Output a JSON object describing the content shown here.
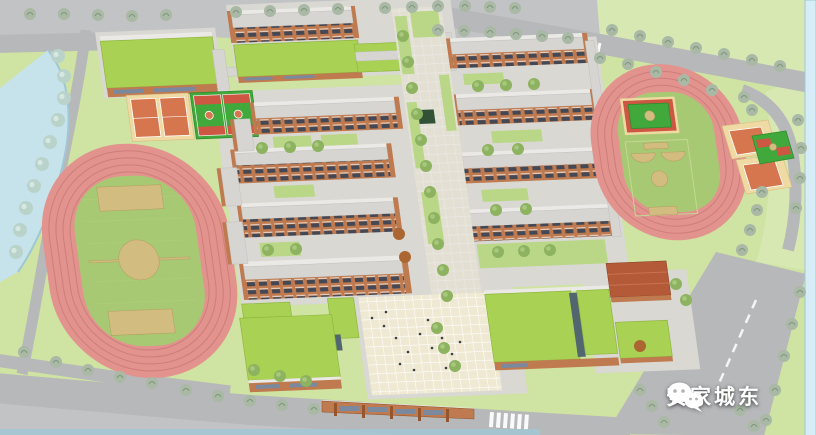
{
  "watermark": {
    "icon": "wechat-icon",
    "text": "安家城东"
  },
  "scene": {
    "type": "aerial-architectural-rendering",
    "features": [
      "running-track-west",
      "soccer-field",
      "tennis-courts-north",
      "basketball-courts-north",
      "gymnasium-green-roof",
      "dormitory-building-north",
      "classroom-buildings",
      "central-walkway",
      "entry-plaza",
      "entrance-gate",
      "canteen-green-roof",
      "running-track-east",
      "basketball-courts-east",
      "perimeter-roads",
      "street-trees",
      "waterway-west",
      "waterway-east",
      "lawn-northeast"
    ]
  },
  "colors": {
    "grass": "#cfe3a2",
    "grass-light": "#d8e8b2",
    "gray-lot": "#c2c3c5",
    "water": "#c6e3eb",
    "water-edge": "#9fc7d4",
    "water-right": "#d6edf7",
    "road": "#b7b8ba",
    "track": "#e2938e",
    "track-line": "#c2706c",
    "infield": "#a7c973",
    "marking-tan": "#d2bc80",
    "lawn": "#b9d787",
    "green-roof": "#a9d254",
    "green-roof-line": "#8fb640",
    "roof": "#d6d5d1",
    "roof-ridge": "#ebe9e5",
    "paving": "#d9d8d3",
    "plaza": "#efe9d3",
    "plaza-line": "#ffffff",
    "brick": "#bf7a4f",
    "brick-dark": "#94562f",
    "window": "#434854",
    "window-blue": "#6f8cac",
    "court-cream": "#eedaa2",
    "court-orange": "#d5764e",
    "court-green": "#41a83c",
    "court-red": "#cd5742",
    "terracotta": "#b45a39",
    "skylight": "#51666f",
    "pond": "#315237",
    "tree-street": "#a9b9a5",
    "tree-street-line": "#7f977b",
    "tree-bank": "#b9d3cb",
    "tree-bank-hi": "#d6e8e1",
    "tree-campus": "#8db361",
    "tree-campus-hi": "#a9c87e",
    "tree-autumn": "#ac6631",
    "people": "#3c4043",
    "watermark-text": "#ffffff"
  }
}
